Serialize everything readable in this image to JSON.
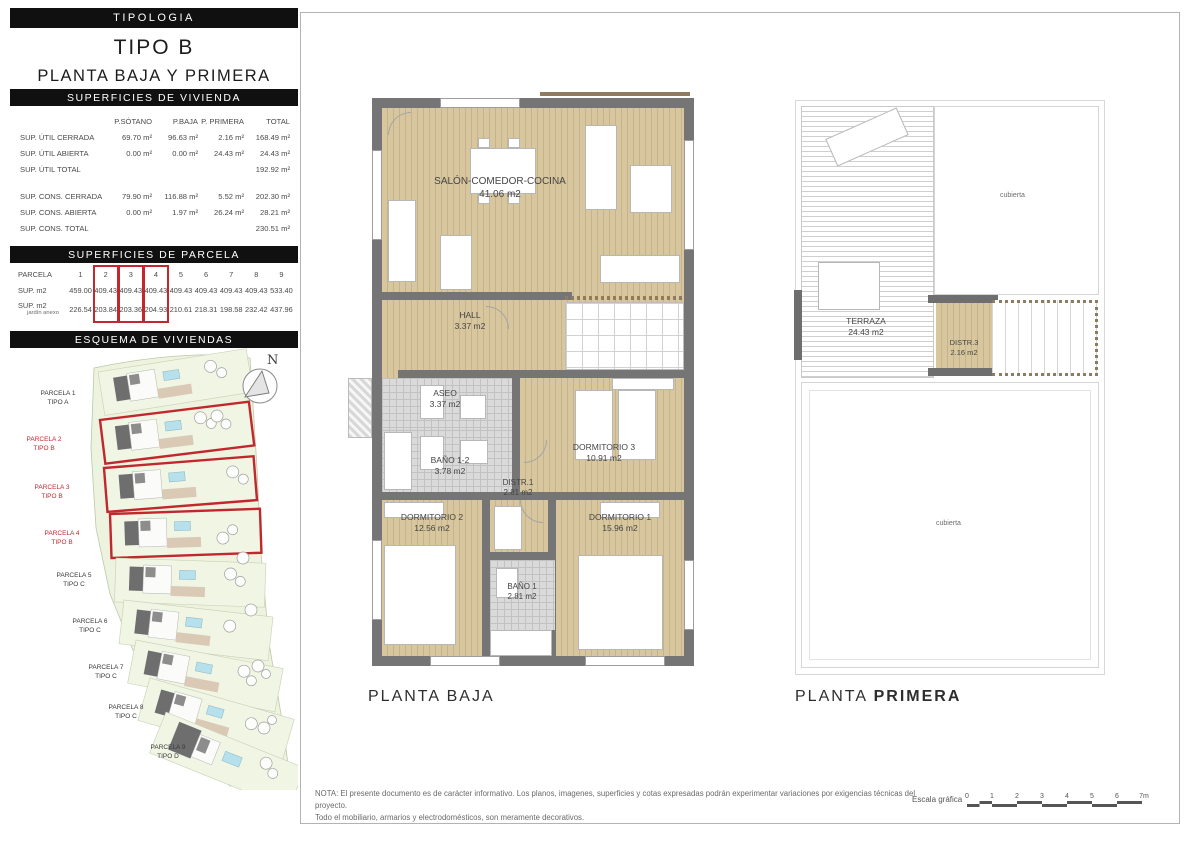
{
  "header": {
    "tipologia": "TIPOLOGIA",
    "tipo": "TIPO B",
    "subtitle": "PLANTA BAJA Y PRIMERA"
  },
  "vivienda": {
    "title": "SUPERFICIES DE VIVIENDA",
    "columns": [
      "P.SÓTANO",
      "P.BAJA",
      "P. PRIMERA",
      "TOTAL"
    ],
    "rows": [
      {
        "label": "SUP. ÚTIL CERRADA",
        "values": [
          "69.70 m²",
          "96.63 m²",
          "2.16 m²",
          "168.49 m²"
        ]
      },
      {
        "label": "SUP. ÚTIL ABIERTA",
        "values": [
          "0.00 m²",
          "0.00 m²",
          "24.43 m²",
          "24.43 m²"
        ]
      },
      {
        "label": "SUP. ÚTIL TOTAL",
        "values": [
          "",
          "",
          "",
          "192.92 m²"
        ]
      },
      {
        "label": "SUP. CONS. CERRADA",
        "values": [
          "79.90 m²",
          "116.88 m²",
          "5.52 m²",
          "202.30 m²"
        ]
      },
      {
        "label": "SUP. CONS. ABIERTA",
        "values": [
          "0.00 m²",
          "1.97 m²",
          "26.24 m²",
          "28.21 m²"
        ]
      },
      {
        "label": "SUP. CONS. TOTAL",
        "values": [
          "",
          "",
          "",
          "230.51 m²"
        ]
      }
    ]
  },
  "parcela": {
    "title": "SUPERFICIES DE PARCELA",
    "row_label": "PARCELA",
    "sup_label": "SUP. m2",
    "jardin_label": "SUP. m2",
    "jardin_sublabel": "jardín anexo",
    "numbers": [
      "1",
      "2",
      "3",
      "4",
      "5",
      "6",
      "7",
      "8",
      "9"
    ],
    "sup": [
      "459.00",
      "409.43",
      "409.43",
      "409.43",
      "409.43",
      "409.43",
      "409.43",
      "409.43",
      "533.40"
    ],
    "jardin": [
      "226.54",
      "203.84",
      "203.36",
      "204.93",
      "210.61",
      "218.31",
      "198.58",
      "232.42",
      "437.96"
    ]
  },
  "esquema": {
    "title": "ESQUEMA DE VIVIENDAS",
    "compass_label": "N",
    "parcels": [
      {
        "name": "PARCELA 1",
        "tipo": "TIPO A"
      },
      {
        "name": "PARCELA 2",
        "tipo": "TIPO B"
      },
      {
        "name": "PARCELA 3",
        "tipo": "TIPO B"
      },
      {
        "name": "PARCELA 4",
        "tipo": "TIPO B"
      },
      {
        "name": "PARCELA 5",
        "tipo": "TIPO C"
      },
      {
        "name": "PARCELA 6",
        "tipo": "TIPO C"
      },
      {
        "name": "PARCELA 7",
        "tipo": "TIPO C"
      },
      {
        "name": "PARCELA 8",
        "tipo": "TIPO C"
      },
      {
        "name": "PARCELA 9",
        "tipo": "TIPO D"
      }
    ]
  },
  "planta_baja": {
    "label": "PLANTA BAJA",
    "rooms": [
      {
        "name": "SALÓN-COMEDOR-COCINA",
        "area": "41.06 m2"
      },
      {
        "name": "HALL",
        "area": "3.37 m2"
      },
      {
        "name": "ASEO",
        "area": "3.37 m2"
      },
      {
        "name": "BAÑO 1-2",
        "area": "3.78 m2"
      },
      {
        "name": "DISTR.1",
        "area": "2.81 m2"
      },
      {
        "name": "DORMITORIO 3",
        "area": "10.91 m2"
      },
      {
        "name": "DORMITORIO 2",
        "area": "12.56 m2"
      },
      {
        "name": "DORMITORIO 1",
        "area": "15.96 m2"
      },
      {
        "name": "BAÑO 1",
        "area": "2.81 m2"
      }
    ]
  },
  "planta_primera": {
    "label_part1": "PLANTA",
    "label_part2": "PRIMERA",
    "rooms": [
      {
        "name": "TERRAZA",
        "area": "24.43 m2"
      },
      {
        "name": "DISTR.3",
        "area": "2.16 m2"
      }
    ],
    "cubierta_top": "cubierta",
    "cubierta_bottom": "cubierta"
  },
  "nota": {
    "line1": "NOTA: El presente documento es de carácter informativo. Los planos, imagenes, superficies y cotas expresadas podrán experimentar variaciones por exigencias técnicas del proyecto.",
    "line2": "Todo el mobiliario, armarios y electrodomésticos, son meramente decorativos."
  },
  "escala": {
    "label": "Escala gráfica",
    "ticks": [
      "0",
      "1",
      "2",
      "3",
      "4",
      "5",
      "6",
      "7m"
    ]
  }
}
